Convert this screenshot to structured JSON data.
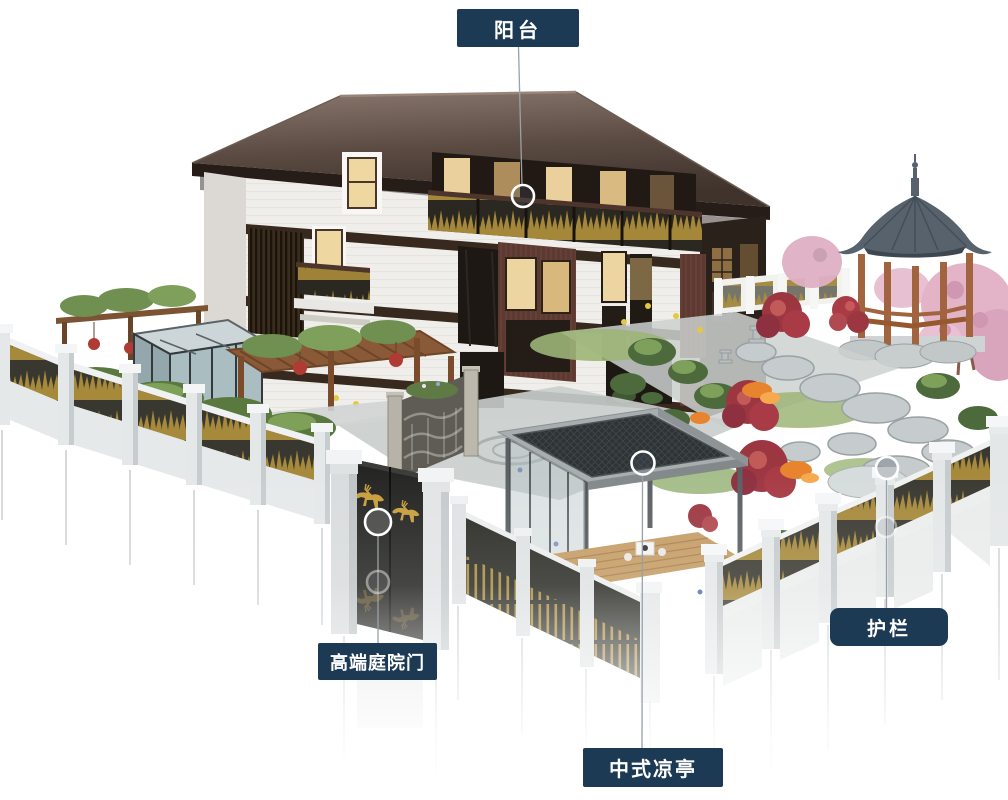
{
  "annotations": {
    "balcony": {
      "label": "阳台"
    },
    "gate": {
      "label": "高端庭院门"
    },
    "pavilion": {
      "label": "中式凉亭"
    },
    "railing": {
      "label": "护栏"
    }
  },
  "palette": {
    "label_bg": "#1d3a55",
    "label_text": "#ffffff",
    "callout_line": "#98a1a9",
    "marker_ring": "#ffffff",
    "gold_accent": "#b2923c",
    "roof_brown": "#5a4a42",
    "fence_panel": "#393830",
    "gazebo_roof": "#5a6570",
    "wood_brown": "#a2643f"
  }
}
